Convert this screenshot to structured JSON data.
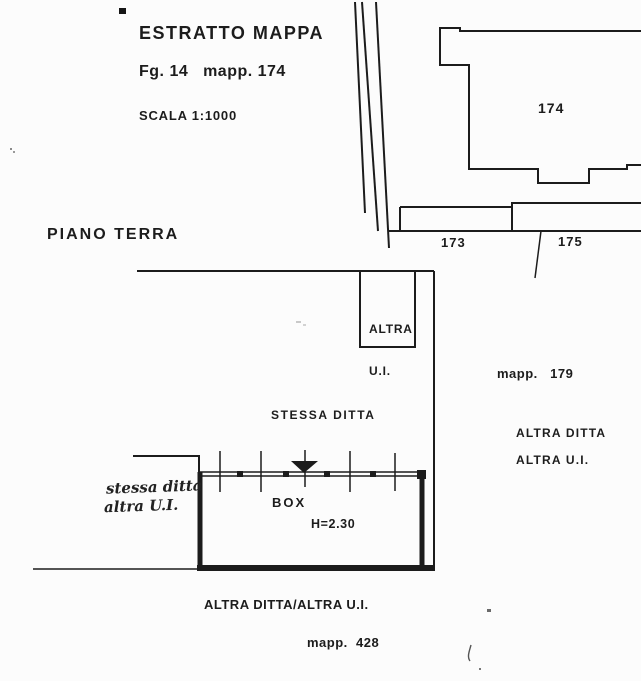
{
  "header": {
    "title": "ESTRATTO MAPPA",
    "sheet_ref": "Fg. 14   mapp. 174",
    "scale": "SCALA 1:1000"
  },
  "map": {
    "parcel_main": "174",
    "parcel_left": "173",
    "parcel_right": "175",
    "mapp_179": "mapp.   179",
    "mapp_428": "mapp.  428"
  },
  "plan": {
    "title": "PIANO TERRA",
    "altra_ui_line1": "ALTRA",
    "altra_ui_line2": "U.I.",
    "stessa_ditta": "STESSA DITTA",
    "handwritten_line1": "stessa ditta",
    "handwritten_line2": "altra U.I.",
    "box_label": "BOX",
    "box_height": "H=2.30",
    "right_owner_line1": "ALTRA DITTA",
    "right_owner_line2": "ALTRA U.I.",
    "bottom_owner": "ALTRA DITTA/ALTRA U.I."
  },
  "colors": {
    "ink": "#1c1c1c",
    "paper": "#fcfcfc"
  }
}
